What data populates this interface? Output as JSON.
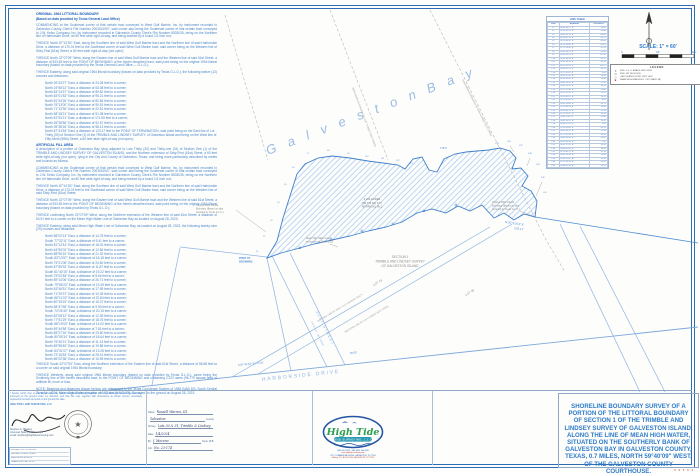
{
  "sheet": {
    "scale_label": "SCALE: 1\" = 60'",
    "scale_ticks": [
      "0",
      "60'",
      "120'"
    ],
    "sheet_code": "9 9 6 6 3"
  },
  "line_table": {
    "title": "LINE TABLE",
    "headers": [
      "LINE",
      "BEARING",
      "DISTANCE"
    ],
    "rows": [
      [
        "L1",
        "N 06°43'27\" E",
        "24.28'"
      ],
      [
        "L2",
        "N 19°56'13\" E",
        "53.08'"
      ],
      [
        "L3",
        "N 84°14'37\" E",
        "89.82'"
      ],
      [
        "L4",
        "N 83°01'53\" E",
        "95.21'"
      ],
      [
        "L5",
        "N 81°44'26\" E",
        "82.84'"
      ],
      [
        "L6",
        "N 78°13'00\" E",
        "90.91'"
      ],
      [
        "L7",
        "N 71°13'36\" E",
        "22.51'"
      ],
      [
        "L8",
        "N 58°18'21\" E",
        "91.38'"
      ],
      [
        "L9",
        "N 81°53'11\" E",
        "171.55'"
      ],
      [
        "L10",
        "N 35°36'56\" E",
        "92.57'"
      ],
      [
        "L11",
        "N 06°38'16\" E",
        "58.13'"
      ],
      [
        "L12",
        "N 87°41'53\" E",
        "123.17'"
      ],
      [
        "L13",
        "N 88°02'13\" E",
        "14.75'"
      ],
      [
        "L14",
        "S 77°32'11\" E",
        "9.41'"
      ],
      [
        "L15",
        "N 81°12'44\" E",
        "18.03'"
      ],
      [
        "L16",
        "N 64°50'02\" E",
        "12.66'"
      ],
      [
        "L17",
        "N 88°59'10\" E",
        "21.32'"
      ],
      [
        "L18",
        "S 83°13'57\" E",
        "16.18'"
      ],
      [
        "L19",
        "N 79°21'08\" E",
        "24.60'"
      ],
      [
        "L20",
        "N 87°55'32\" E",
        "11.87'"
      ],
      [
        "L21",
        "S 81°40'15\" E",
        "19.22'"
      ],
      [
        "L22",
        "N 75°02'48\" E",
        "8.54'"
      ],
      [
        "L23",
        "N 89°14'06\" E",
        "26.71'"
      ],
      [
        "L24",
        "S 79°58'23\" E",
        "13.49'"
      ],
      [
        "L25",
        "N 83°46'51\" E",
        "17.95'"
      ],
      [
        "L26",
        "N 71°29'37\" E",
        "10.28'"
      ],
      [
        "L27",
        "S 86°11'02\" E",
        "22.84'"
      ],
      [
        "L28",
        "N 80°33'19\" E",
        "15.07'"
      ],
      [
        "L29",
        "N 88°47'55\" E",
        "9.93'"
      ],
      [
        "L30",
        "S 74°26'40\" E",
        "20.15'"
      ],
      [
        "L31",
        "N 82°08'12\" E",
        "12.39'"
      ],
      [
        "L32",
        "N 77°51'29\" E",
        "18.76'"
      ],
      [
        "L33",
        "S 88°19'03\" E",
        "14.02'"
      ],
      [
        "L34",
        "N 69°44'58\" E",
        "7.81'"
      ],
      [
        "L35",
        "N 85°27'16\" E",
        "23.50'"
      ],
      [
        "L36",
        "S 80°05'34\" E",
        "16.64'"
      ],
      [
        "L37",
        "N 76°40'21\" E",
        "11.13'"
      ],
      [
        "L38",
        "N 89°58'45\" E",
        "19.88'"
      ],
      [
        "L39",
        "S 84°31'07\" E",
        "13.26'"
      ],
      [
        "L40",
        "N 73°16'53\" E",
        "25.41'"
      ],
      [
        "L41",
        "N 86°02'38\" E",
        "15.59'"
      ]
    ]
  },
  "legend": {
    "title": "LEGEND",
    "items": [
      {
        "sym": "✶",
        "label": "FND. G.L.O. BRASS DISC MON."
      },
      {
        "sym": "⊙",
        "label": "FND. 5/8\" IRON ROD"
      },
      {
        "sym": "△",
        "label": "CALCULATED POINT (NOT SET)"
      },
      {
        "sym": "■",
        "label": "MEAN HIGH WATER EL. 0.92' (NAVD 88)"
      }
    ]
  },
  "legal": {
    "h1": "ORIGINAL 1964 LITTORAL BOUNDARY",
    "h1b": "(Based on data provided by Texas General Land Office)",
    "paras1": [
      "COMMENCING at the Southeast corner of that certain tract conveyed to West Gulf Marine, Inc. by instrument recorded in Galveston County Clerk's File Number 2003041907, said corner also being the Southeast corner of that certain tract conveyed to J.W. Kelso Company, Inc. by instrument recorded in Galveston County Clerk's File Number 8533035, being on the Northern line of Harborside Drive, an 80 feet wide right-of-way, and being marked by a found 1/2 inch rod;",
      "THENCE North 87°41'53\" East, along the Southern line of said West Gulf Marine tract and the Northern line of said Harborside Drive, a distance of 170.01 feet to the Southeast corner of said West Gulf Marine tract, said corner being on the Western line of Sixty-First (61st) Street, a 60 feet wide right-of-way (not open);",
      "THENCE North 22°07'09\" West, along the Eastern line of said West Gulf Marine tract and the Western line of said 61st Street, a distance of 533.83 feet to the POINT OF BEGINNING of the herein described tract, said point being on the original 1964 littoral boundary (based on data provided by the Texas General Land Office — G.L.O.);",
      "THENCE Easterly, along said original 1964 littoral boundary (based on data provided by Texas G.L.O.), the following twelve (12) courses and distances:"
    ],
    "courses1": [
      "North 06°43'27\" East, a distance of 24.28 feet to a corner;",
      "North 19°56'13\" East, a distance of 53.08 feet to a corner;",
      "North 84°14'37\" East, a distance of 89.82 feet to a corner;",
      "North 83°01'53\" East, a distance of 95.21 feet to a corner;",
      "North 81°44'26\" East, a distance of 82.84 feet to a corner;",
      "North 78°13'00\" East, a distance of 90.91 feet to a corner;",
      "North 71°13'36\" East, a distance of 22.51 feet to a corner;",
      "North 58°18'21\" East, a distance of 91.38 feet to a corner;",
      "North 81°53'11\" East, a distance of 171.55 feet to a corner;",
      "North 35°36'56\" East, a distance of 92.57 feet to a corner;",
      "North 06°38'16\" East, a distance of 58.13 feet to a corner;",
      "North 87°41'53\" East, a distance of 123.17 feet to the POINT OF TERMINATION, said point being on the East line of Lot Thirty (30) of Section One (1) of the TRIMBLE AND LINDSEY SURVEY, of Galveston Island and being on the West line of Fifty-Ninth (59th) Street, a 60 feet wide right-of-way (not open);"
    ],
    "h2": "ARTIFICIAL FILL AREA",
    "paras2": [
      "A description of a portion of Galveston Bay lying adjacent to Lots Thirty (30) and Thirty-one (31) of Section One (1) of the TRIMBLE AND LINDSEY SURVEY OF GALVESTON ISLAND, and the Northern extension of Sixty-First (61st) Street, a 60 feet wide right-of-way (not open), lying in the City and County of Galveston, Texas; and being more particularly described by metes and bounds as follows:",
      "COMMENCING at the Southeast corner of that certain tract conveyed to West Gulf Marine, Inc. by instrument recorded in Galveston County Clerk's File Number 2003041907, said corner also being the Southeast corner of that certain tract conveyed to J.W. Kelso Company, Inc. by instrument recorded in Galveston County Clerk's File Number 8533035, being on the Northern line of Harborside Drive, an 80 feet wide right-of-way, and being marked by a found 1/2 inch rod;",
      "THENCE North 87°41'53\" East, along the Southern line of said West Gulf Marine tract and the Northern line of said Harborside Drive, a distance of 170.01 feet to the Southeast corner of said West Gulf Marine tract, said corner being on the Western line of said Sixty-First (61st) Street;",
      "THENCE North 22°07'09\" West, along the Eastern line of said West Gulf Marine tract and the Western line of said 61st Street, a distance of 533.83 feet to the POINT OF BEGINNING of the herein described tract, said point being on the original 1964 littoral boundary (based on data provided by Texas G.L.O.);",
      "THENCE continuing North 22°07'09\" West, along the Northern extension of the Western line of said 61st Street, a distance of 63.91 feet to a corner on the Mean High Water Line of Galveston Bay as located on August 28, 2023;",
      "THENCE Easterly, along said Mean High Water Line of Galveston Bay, as located on August 28, 2023, the following twenty-nine (29) courses and distances:"
    ],
    "courses2": [
      "North 88°02'13\" East, a distance of 14.75 feet to a corner;",
      "South 77°32'11\" East, a distance of 9.41 feet to a corner;",
      "North 81°12'44\" East, a distance of 18.03 feet to a corner;",
      "North 64°50'02\" East, a distance of 12.66 feet to a corner;",
      "North 88°59'10\" East, a distance of 21.32 feet to a corner;",
      "South 83°13'57\" East, a distance of 16.18 feet to a corner;",
      "North 79°21'08\" East, a distance of 24.60 feet to a corner;",
      "North 87°55'32\" East, a distance of 11.87 feet to a corner;",
      "South 81°40'15\" East, a distance of 19.22 feet to a corner;",
      "North 75°02'48\" East, a distance of 8.54 feet to a corner;",
      "North 89°14'06\" East, a distance of 26.71 feet to a corner;",
      "South 79°58'23\" East, a distance of 13.49 feet to a corner;",
      "North 83°46'51\" East, a distance of 17.95 feet to a corner;",
      "North 71°29'37\" East, a distance of 10.28 feet to a corner;",
      "South 86°11'02\" East, a distance of 22.84 feet to a corner;",
      "North 80°33'19\" East, a distance of 15.07 feet to a corner;",
      "North 88°47'55\" East, a distance of 9.93 feet to a corner;",
      "South 74°26'40\" East, a distance of 20.15 feet to a corner;",
      "North 82°08'12\" East, a distance of 12.39 feet to a corner;",
      "North 77°51'29\" East, a distance of 18.76 feet to a corner;",
      "South 88°19'03\" East, a distance of 14.02 feet to a corner;",
      "North 69°44'58\" East, a distance of 7.81 feet to a corner;",
      "North 85°27'16\" East, a distance of 23.50 feet to a corner;",
      "South 80°05'34\" East, a distance of 16.64 feet to a corner;",
      "North 76°40'21\" East, a distance of 11.13 feet to a corner;",
      "North 89°58'45\" East, a distance of 19.88 feet to a corner;",
      "South 84°31'07\" East, a distance of 13.26 feet to a corner;",
      "North 73°16'53\" East, a distance of 25.41 feet to a corner;",
      "North 86°02'38\" East, a distance of 15.59 feet to a corner;"
    ],
    "paras3": [
      "THENCE South 22°07'09\" East, along the Northern extension of the Eastern line of said 61st Street, a distance of 58.88 feet to a corner on said original 1964 littoral boundary;",
      "THENCE Westerly, along said original 1964 littoral boundary (based on data provided by Texas G.L.O.), same being the Southerly line of the herein described tract, to the POINT OF BEGINNING and containing 2.222 acres (96,779 square feet) of artificial fill, more or less."
    ],
    "note": "NOTE: Bearings and distances shown hereon are referenced to the Texas Coordinate System of 1983 (NAD 83), South Central Zone No. 4204. Mean High Water elevation of 0.92 feet (NAVD 88). Surveyed on the ground on August 28, 2023."
  },
  "map": {
    "bay_label": "G a l v e s t o n    B a y",
    "harborside": "HARBORSIDE  DRIVE",
    "road_bearing": "S 87°41'53\" E   174.01'",
    "road_dist": "50.00'",
    "street_name": "61ST STREET",
    "street_row": "(60' R.O.W. - NOT OPEN)",
    "ext61": "NORTHERN EXTENSION OF 61ST STREET (NOT OPEN)",
    "ext59": "NORTHERN EXTENSION OF 59TH STREET (NOT OPEN)",
    "diag_label1": "EASTERN LINE OF WEST GULF MARINE TRACT",
    "diag_label2": "WESTERN LINE OF 61ST STREET (NOT OPEN)",
    "tip_bearing": "N 87°41'53\" E",
    "tip_dist": "123.17'",
    "dist_178": "178.5'",
    "section_lines": [
      "SECTION 1",
      "TRIMBLE AND LINDSEY SURVEY",
      "OF GALVESTON ISLAND"
    ],
    "lot31": "LOT 31",
    "lot30": "LOT 30",
    "note_1964": [
      "Original 1964 Littoral",
      "Boundary (Based on data",
      "provided by Texas G.L.O.)"
    ],
    "acres": [
      "2.222 ACRES",
      "(96,779 SQ. FT.)",
      "ARTIFICIAL FILL"
    ],
    "mhw": [
      "Mean High Water Line",
      "as located on 08-28-2023"
    ],
    "pob": [
      "POINT OF",
      "BEGINNING"
    ],
    "seg_labels": [
      "L1",
      "L2",
      "L3",
      "L4",
      "L5",
      "L6",
      "L7",
      "L8",
      "L9",
      "L10",
      "L11",
      "L12",
      "L13",
      "L35",
      "L36",
      "L37",
      "L38",
      "L39",
      "L40",
      "L41"
    ]
  },
  "certification": {
    "text": "I hereby certify that on the below date, the herein described property, together with improvements located thereon, was surveyed on the ground under my direction, and that this map, together with dimensions as shown hereon, accurately represents the facts as found on the ground this date.",
    "company": "HIGH TIDE LAND SURVEYING, LLC",
    "name_lines": [
      "Stephen C. Blaskey",
      "Licensed State Land Surveyor",
      "email: stephen@hightidesurveying.com"
    ],
    "revisions": [
      "REVISED 01-17-24  NOTES",
      "REVISED 12-08-23  CLIENT",
      "FIELD WORK 08-28-23",
      "DRAWN J.M.   CHK. S.C.B."
    ]
  },
  "form": {
    "fields": [
      {
        "label": "Name:",
        "value": "Russell Warren, III",
        "suffix": ""
      },
      {
        "label": "",
        "value": "Galveston",
        "suffix": "County"
      },
      {
        "label": "Survey:",
        "value": "Lots 30 & 31, Trimble & Lindsey",
        "suffix": ""
      },
      {
        "label": "Date:",
        "value": "1/4/2024",
        "suffix": ""
      },
      {
        "label": "By:",
        "value": "J. Moreno",
        "suffix": "Crew: W.B."
      },
      {
        "label": "Job:",
        "value": "No. 23-174",
        "suffix": ""
      }
    ]
  },
  "logo": {
    "name": "High Tide",
    "banner": "LAND SURVEYING, L.L.C.",
    "addr": [
      "(409) 740-1919  ·  FAX (409) 740-1920",
      "www.hightidesurveying.com",
      "2717 COMMERCIAL DRIVE, GALVESTON, TX 77554",
      "Mailing: P.O. BOX 16743, GALVESTON, TX 77552"
    ]
  },
  "title_block": {
    "text": "SHORELINE BOUNDARY SURVEY OF A PORTION OF THE LITTORAL BOUNDARY OF SECTION 1 OF THE TRIMBLE AND LINDSEY SURVEY OF GALVESTON ISLAND, ALONG THE LINE OF MEAN HIGH WATER, SITUATED ON THE SOUTHERLY BANK OF GALVESTON BAY IN GALVESTON COUNTY, TEXAS, 0.7 MILES, NORTH 59°40'09\" WEST, OF THE GALVESTON COUNTY COURTHOUSE."
  }
}
